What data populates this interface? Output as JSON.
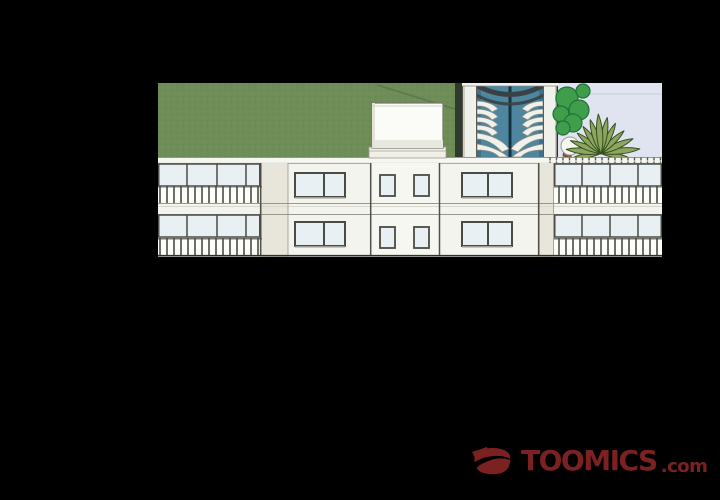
{
  "watermark": {
    "brand": "TOOMICS",
    "suffix": ".com"
  },
  "colors": {
    "page_bg": "#000000",
    "logo": "#7c2122",
    "hedge": "#6f8d57",
    "hedge_shadow": "#58784a",
    "dark_strip": "#2e3a2b",
    "sky": "#e0e4f1",
    "sky_line": "#c4cadb",
    "tower_glass": "#4e86a0",
    "tower_glass_dark": "#17323e",
    "tower_arch": "#3a4145",
    "tower_frame": "#eff1ea",
    "tower_frame_shadow": "#cbcdc1",
    "facade": "#f4f4ee",
    "facade_side": "#e8e6db",
    "window_glass": "#e9f0f4",
    "outline": "#4b4b45",
    "soft_line": "#97978d",
    "parapet": "#f7f7f2",
    "roof_box": "#fbfbf7",
    "tree": "#3f9e4a",
    "tree_dark": "#20713a",
    "palm": "#8ea55f",
    "palm_dark": "#32501f",
    "trunk": "#8a6138",
    "blob": "#f5f5f2"
  }
}
